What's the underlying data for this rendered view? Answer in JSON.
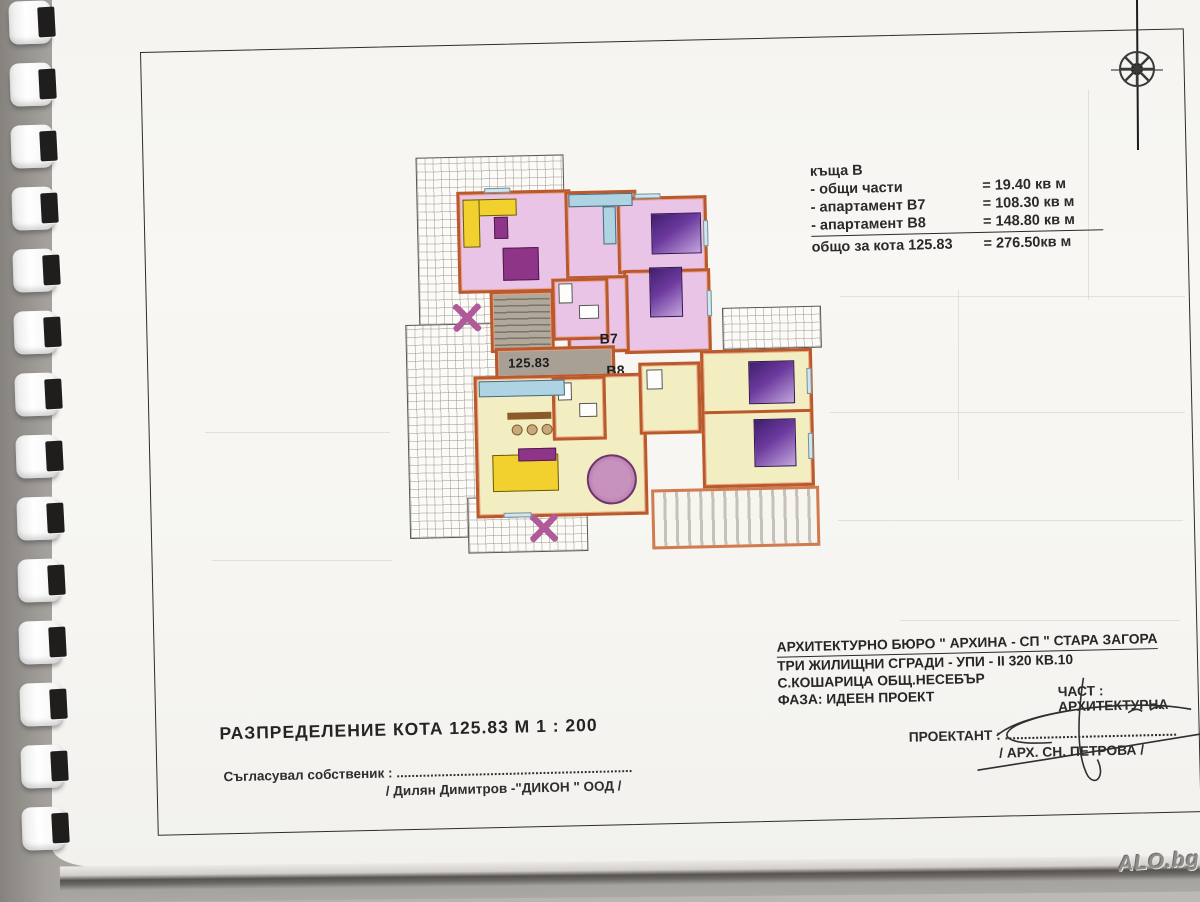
{
  "area_table": {
    "title": "къща  В",
    "rows": [
      {
        "label": "- общи части",
        "value": "=  19.40 кв м"
      },
      {
        "label": "- апартамент В7",
        "value": "= 108.30 кв м"
      },
      {
        "label": "- апартамент В8",
        "value": "= 148.80 кв м"
      }
    ],
    "total": {
      "label": "общо   за кота 125.83",
      "value": "= 276.50кв м"
    }
  },
  "plan": {
    "elevation_label": "125.83",
    "apartment_b7_label": "B7",
    "apartment_b8_label": "B8"
  },
  "title_block": {
    "drawing_title": "РАЗПРЕДЕЛЕНИЕ  КОТА 125.83  М 1 : 200",
    "owner_label": "Съгласувал собственик : ...............................................................",
    "owner_name": "/  Дилян Димитров -\"ДИКОН \" ООД  /"
  },
  "project_block": {
    "line1": "АРХИТЕКТУРНО  БЮРО  \" АРХИНА - СП \" СТАРА ЗАГОРА",
    "line2": "ТРИ  ЖИЛИЩНИ  СГРАДИ  - УПИ - II 320  КВ.10",
    "line3": "С.КОШАРИЦА  ОБЩ.НЕСЕБЪР",
    "line4": "ФАЗА: ИДЕЕН  ПРОЕКТ",
    "part_label": "ЧАСТ : АРХИТЕКТУРНА",
    "designer_label": "ПРОЕКТАНТ : .............................................",
    "designer_name": "/ АРХ. СН. ПЕТРОВА /"
  },
  "watermark": "ALO.bg",
  "colors": {
    "wall": "#b9592c",
    "apartment_b7_floor": "#e9c4e6",
    "apartment_b8_floor": "#f2eec2",
    "corridor": "#a8a094",
    "kitchen_counter": "#aed3e3",
    "bed": "#5f2d8f",
    "sofa": "#f2d12e",
    "table": "#8f3588"
  }
}
